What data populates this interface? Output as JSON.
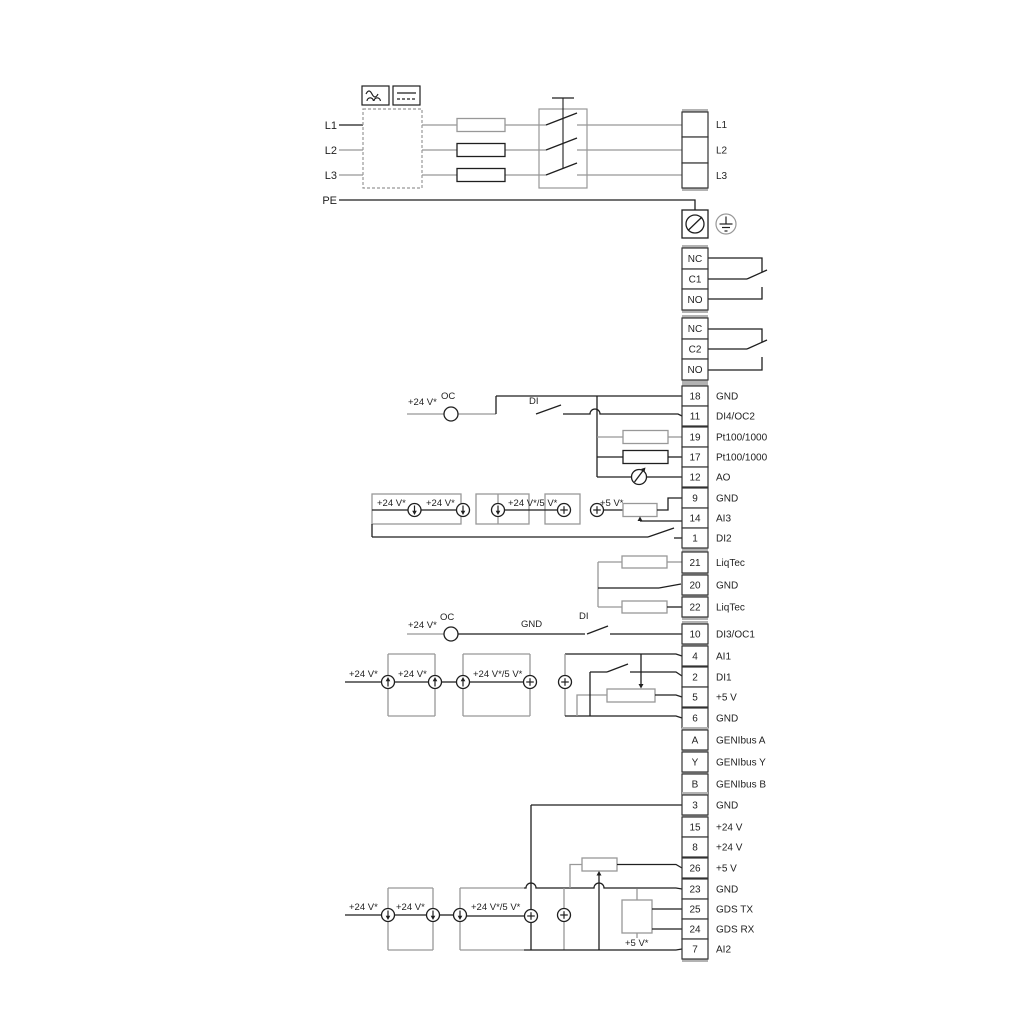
{
  "power": {
    "inputs": [
      "L1",
      "L2",
      "L3",
      "PE"
    ],
    "outputs": [
      "L1",
      "L2",
      "L3"
    ]
  },
  "relays": [
    {
      "terminals": [
        "NC",
        "C1",
        "NO"
      ]
    },
    {
      "terminals": [
        "NC",
        "C2",
        "NO"
      ]
    }
  ],
  "groups": {
    "io1": [
      {
        "num": "18",
        "label": "GND"
      },
      {
        "num": "11",
        "label": "DI4/OC2"
      },
      {
        "num": "19",
        "label": "Pt100/1000"
      },
      {
        "num": "17",
        "label": "Pt100/1000"
      },
      {
        "num": "12",
        "label": "AO"
      },
      {
        "num": "9",
        "label": "GND"
      },
      {
        "num": "14",
        "label": "AI3"
      },
      {
        "num": "1",
        "label": "DI2"
      }
    ],
    "liqtec": [
      {
        "num": "21",
        "label": "LiqTec"
      },
      {
        "num": "20",
        "label": "GND"
      },
      {
        "num": "22",
        "label": "LiqTec"
      }
    ],
    "io2": [
      {
        "num": "10",
        "label": "DI3/OC1"
      },
      {
        "num": "4",
        "label": "AI1"
      },
      {
        "num": "2",
        "label": "DI1"
      },
      {
        "num": "5",
        "label": "+5 V"
      },
      {
        "num": "6",
        "label": "GND"
      }
    ],
    "genibus": [
      {
        "num": "A",
        "label": "GENIbus A"
      },
      {
        "num": "Y",
        "label": "GENIbus Y"
      },
      {
        "num": "B",
        "label": "GENIbus B"
      }
    ],
    "io3": [
      {
        "num": "3",
        "label": "GND"
      },
      {
        "num": "15",
        "label": "+24 V"
      },
      {
        "num": "8",
        "label": "+24 V"
      },
      {
        "num": "26",
        "label": "+5 V"
      },
      {
        "num": "23",
        "label": "GND"
      },
      {
        "num": "25",
        "label": "GDS TX"
      },
      {
        "num": "24",
        "label": "GDS RX"
      },
      {
        "num": "7",
        "label": "AI2"
      }
    ]
  },
  "labels": {
    "v24": "+24 V*",
    "v24_5": "+24 V*/5 V*",
    "v5": "+5 V*",
    "oc": "OC",
    "di": "DI",
    "gnd": "GND"
  },
  "colors": {
    "wire": "#1f1f1f",
    "wire_gray": "#989898",
    "cap_gray": "#b3b3b3"
  }
}
